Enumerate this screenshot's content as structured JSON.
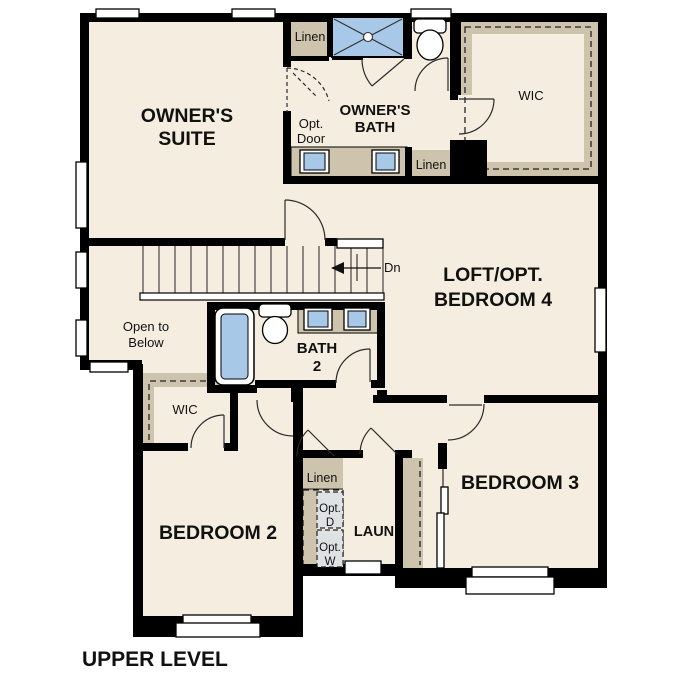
{
  "page_title": "UPPER LEVEL",
  "colors": {
    "wall": "#000000",
    "floor": "#f5eee0",
    "closet_tan": "#cec3ad",
    "fixture_blue": "#a8c8e8",
    "appliance_gray": "#dfe2e5",
    "window_white": "#ffffff",
    "text": "#111111"
  },
  "rooms": {
    "owners_suite": {
      "line1": "OWNER'S",
      "line2": "SUITE"
    },
    "owners_bath": {
      "line1": "OWNER'S",
      "line2": "BATH"
    },
    "owners_wic": {
      "label": "WIC"
    },
    "loft": {
      "line1": "LOFT/OPT.",
      "line2": "BEDROOM 4"
    },
    "open_to_below": {
      "line1": "Open to",
      "line2": "Below"
    },
    "bath2": {
      "line1": "BATH",
      "line2": "2"
    },
    "bedroom2_wic": {
      "label": "WIC"
    },
    "bedroom2": {
      "label": "BEDROOM 2"
    },
    "bedroom3": {
      "label": "BEDROOM 3"
    },
    "laundry": {
      "label": "LAUN"
    }
  },
  "closets": {
    "linen_owners_hall": "Linen",
    "linen_owners_bath": "Linen",
    "linen_hall": "Linen"
  },
  "annotations": {
    "opt_door": {
      "line1": "Opt.",
      "line2": "Door"
    },
    "opt_dryer": {
      "line1": "Opt.",
      "line2": "D"
    },
    "opt_washer": {
      "line1": "Opt.",
      "line2": "W"
    },
    "stair_direction": "Dn"
  }
}
